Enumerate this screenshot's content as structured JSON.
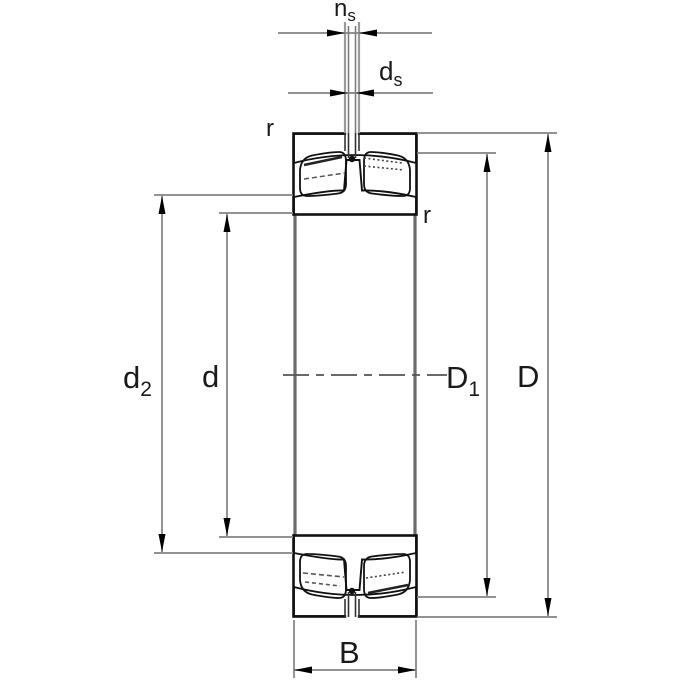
{
  "figure": {
    "kind": "bearing-section-dimension-drawing",
    "description": "Axial cross-section of a spherical roller bearing with lubrication groove and hole, annotated with dimension lines"
  },
  "colors": {
    "background": "#ffffff",
    "outline": "#111111",
    "dimension_line": "#828282",
    "bore_line": "#6b6b6b",
    "centerline": "#555555",
    "arrow": "#000000",
    "cut_face": "#333333"
  },
  "labels": {
    "ns": {
      "base": "n",
      "sub": "s"
    },
    "ds": {
      "base": "d",
      "sub": "s"
    },
    "r_outer": "r",
    "r_inner": "r",
    "d2": {
      "base": "d",
      "sub": "2"
    },
    "d": {
      "base": "d"
    },
    "D1": {
      "base": "D",
      "sub": "1"
    },
    "D": {
      "base": "D"
    },
    "B": {
      "base": "B"
    }
  }
}
